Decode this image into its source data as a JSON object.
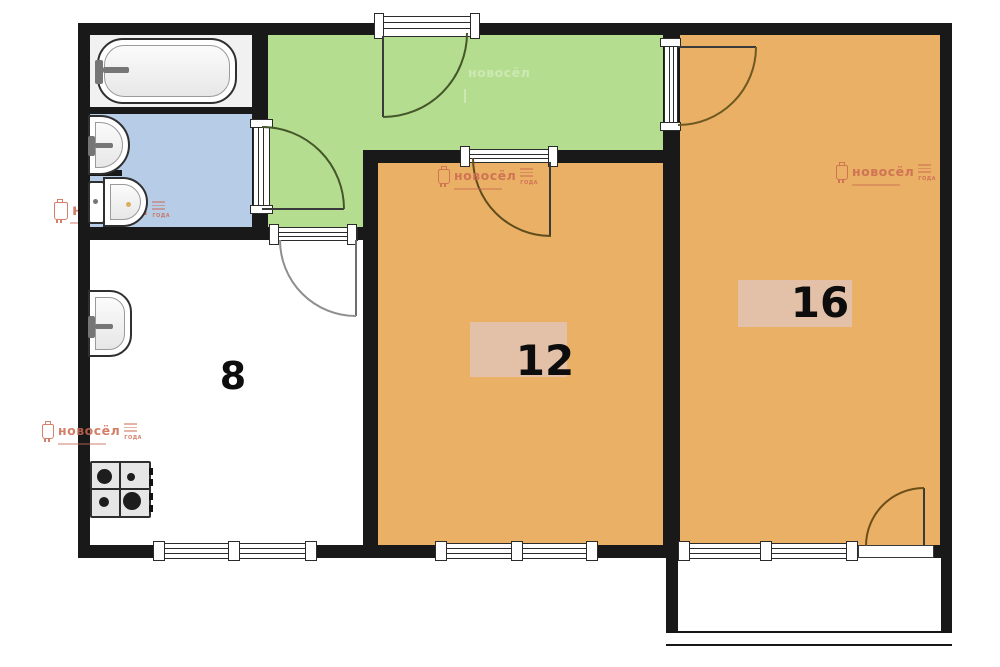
{
  "plan": {
    "room_labels": {
      "kitchen": "8",
      "middle_room": "12",
      "large_room": "16"
    },
    "watermark": {
      "brand": "новосёл",
      "badge": "ГОДА"
    },
    "colors": {
      "hallway_green": "#b5dd8f",
      "room_orange": "#e9b066",
      "bathroom_blue": "#b7cde7",
      "bath_floor": "#f1f1f1",
      "label_box_pink": "#e3c1a8",
      "wall_black": "#191919",
      "watermark_salmon": "#cc6a52"
    }
  }
}
